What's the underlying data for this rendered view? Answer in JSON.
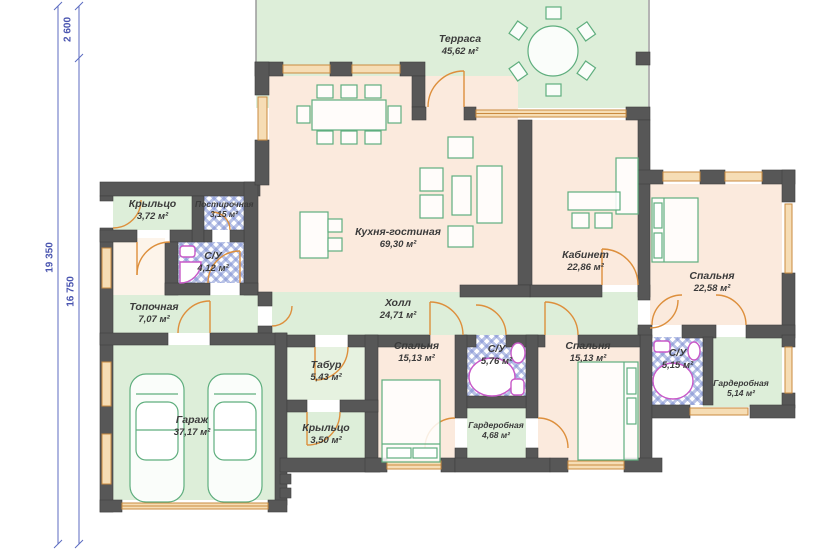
{
  "plan_title": "house-floor-plan",
  "dimensions": {
    "top_segment": "2 600",
    "total_height": "19 350",
    "lower_segment": "16 750"
  },
  "rooms": {
    "terrace": {
      "name": "Терраса",
      "area": "45,62 м²"
    },
    "kitchen_living": {
      "name": "Кухня-гостиная",
      "area": "69,30 м²"
    },
    "office": {
      "name": "Кабинет",
      "area": "22,86 м²"
    },
    "bedroom_1": {
      "name": "Спальня",
      "area": "22,58 м²"
    },
    "porch_upper": {
      "name": "Крыльцо",
      "area": "3,72 м²"
    },
    "laundry": {
      "name": "Постирочная",
      "area": "3,15 м²"
    },
    "bathroom_1": {
      "name": "С/У",
      "area": "4,12 м²"
    },
    "boiler_room": {
      "name": "Топочная",
      "area": "7,07 м²"
    },
    "hall": {
      "name": "Холл",
      "area": "24,71 м²"
    },
    "garage": {
      "name": "Гараж",
      "area": "37,17 м²"
    },
    "vestibule": {
      "name": "Табур",
      "area": "5,43 м²"
    },
    "porch_lower": {
      "name": "Крыльцо",
      "area": "3,50 м²"
    },
    "bedroom_2": {
      "name": "Спальня",
      "area": "15,13 м²"
    },
    "bathroom_2": {
      "name": "С/У",
      "area": "5,76 м²"
    },
    "wardrobe_1": {
      "name": "Гардеробная",
      "area": "4,68 м²"
    },
    "bedroom_3": {
      "name": "Спальня",
      "area": "15,13 м²"
    },
    "bathroom_3": {
      "name": "С/У",
      "area": "5,15 м²"
    },
    "wardrobe_2": {
      "name": "Гардеробная",
      "area": "5,14 м²"
    }
  },
  "colors": {
    "wall": "#575757",
    "room_green": "#ddeed9",
    "room_peach": "#fbeadd",
    "checker_blue": "#7d8fd2",
    "window_orange": "#c98a3f",
    "door_orange": "#dd8f3c",
    "furniture_green": "#5fae7e",
    "fixture_magenta": "#c859c8",
    "dimension_blue": "#4a55b0"
  }
}
